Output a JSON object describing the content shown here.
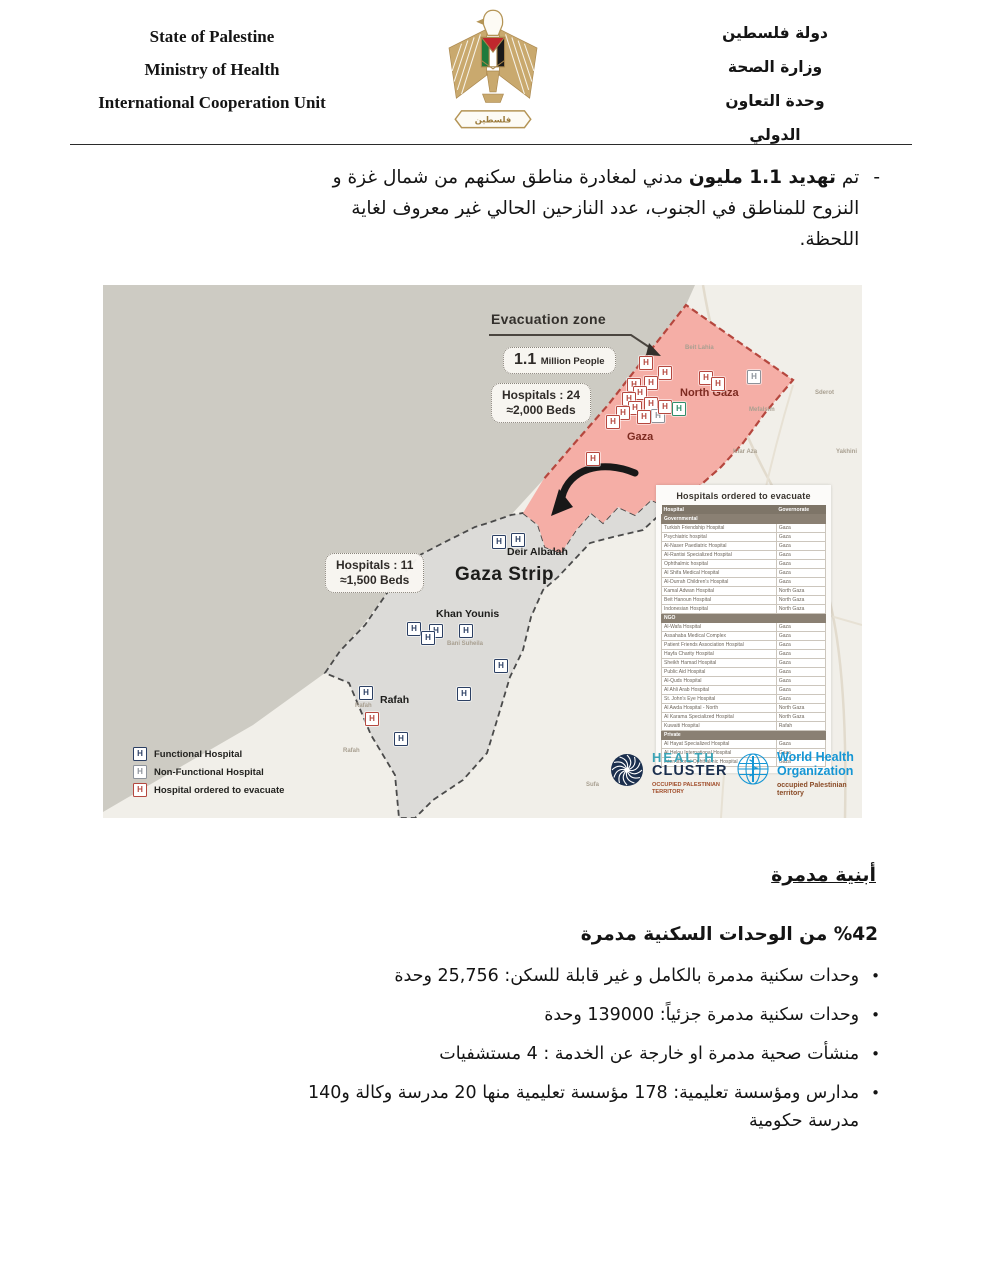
{
  "header": {
    "left_lines": [
      "State of Palestine",
      "Ministry of Health",
      "International Cooperation Unit"
    ],
    "right_lines": [
      "دولة فلسطين",
      "وزارة الصحة",
      "وحدة التعاون الدولي"
    ],
    "emblem_banner": "فلسطين"
  },
  "intro": {
    "dash": "-",
    "pre": "تم ",
    "bold": "تهديد 1.1 مليون",
    "post": " مدني لمغادرة مناطق سكنهم من شمال غزة و النزوح للمناطق في الجنوب، عدد النازحين الحالي غير معروف لغاية اللحظة."
  },
  "map": {
    "marker_letter": "H",
    "evacuation_label": "Evacuation zone",
    "box_people": {
      "big": "1.1",
      "small": "Million People"
    },
    "box_north": {
      "line1": "Hospitals : 24",
      "line2": "≈2,000 Beds"
    },
    "box_south": {
      "line1": "Hospitals : 11",
      "line2": "≈1,500 Beds"
    },
    "region_labels": {
      "north_gaza": "North Gaza",
      "gaza": "Gaza",
      "deir_albalah": "Deir Albalah",
      "gaza_strip": "Gaza Strip",
      "khan_younis": "Khan Younis",
      "rafah": "Rafah"
    },
    "bg_labels": [
      {
        "text": "Beit Lahia",
        "x": 582,
        "y": 60
      },
      {
        "text": "Sderot",
        "x": 712,
        "y": 105
      },
      {
        "text": "Mefalsim",
        "x": 646,
        "y": 122
      },
      {
        "text": "Kfar Aza",
        "x": 630,
        "y": 164
      },
      {
        "text": "Yakhini",
        "x": 733,
        "y": 164
      },
      {
        "text": "Bani Suheila",
        "x": 344,
        "y": 356
      },
      {
        "text": "Rafah",
        "x": 240,
        "y": 463
      },
      {
        "text": "Rafah",
        "x": 252,
        "y": 418
      },
      {
        "text": "Sufa",
        "x": 483,
        "y": 497
      }
    ],
    "markers": [
      {
        "x": 542,
        "y": 77,
        "t": "e"
      },
      {
        "x": 561,
        "y": 87,
        "t": "e"
      },
      {
        "x": 547,
        "y": 97,
        "t": "e"
      },
      {
        "x": 530,
        "y": 99,
        "t": "e"
      },
      {
        "x": 536,
        "y": 107,
        "t": "e"
      },
      {
        "x": 525,
        "y": 113,
        "t": "e"
      },
      {
        "x": 531,
        "y": 122,
        "t": "e"
      },
      {
        "x": 519,
        "y": 127,
        "t": "e"
      },
      {
        "x": 509,
        "y": 136,
        "t": "e"
      },
      {
        "x": 547,
        "y": 118,
        "t": "e"
      },
      {
        "x": 554,
        "y": 130,
        "t": "n"
      },
      {
        "x": 540,
        "y": 131,
        "t": "e"
      },
      {
        "x": 561,
        "y": 121,
        "t": "e"
      },
      {
        "x": 602,
        "y": 92,
        "t": "e"
      },
      {
        "x": 614,
        "y": 98,
        "t": "e"
      },
      {
        "x": 650,
        "y": 91,
        "t": "n"
      },
      {
        "x": 575,
        "y": 123,
        "t": "g"
      },
      {
        "x": 489,
        "y": 173,
        "t": "e"
      },
      {
        "x": 395,
        "y": 256,
        "t": "f"
      },
      {
        "x": 414,
        "y": 254,
        "t": "f"
      },
      {
        "x": 310,
        "y": 343,
        "t": "f"
      },
      {
        "x": 332,
        "y": 345,
        "t": "f"
      },
      {
        "x": 324,
        "y": 352,
        "t": "f"
      },
      {
        "x": 362,
        "y": 345,
        "t": "f"
      },
      {
        "x": 397,
        "y": 380,
        "t": "f"
      },
      {
        "x": 262,
        "y": 407,
        "t": "f"
      },
      {
        "x": 268,
        "y": 433,
        "t": "e"
      },
      {
        "x": 297,
        "y": 453,
        "t": "f"
      },
      {
        "x": 360,
        "y": 408,
        "t": "f"
      }
    ],
    "legend": [
      {
        "type": "f",
        "label": "Functional Hospital"
      },
      {
        "type": "n",
        "label": "Non-Functional Hospital"
      },
      {
        "type": "e",
        "label": "Hospital ordered to evacuate"
      }
    ],
    "table": {
      "title": "Hospitals ordered to evacuate",
      "col1": "Hospital",
      "col2": "Governorate",
      "sections": [
        {
          "name": "Governmental",
          "rows": [
            [
              "Turkish Friendship Hospital",
              "Gaza"
            ],
            [
              "Psychiatric hospital",
              "Gaza"
            ],
            [
              "Al-Naser Paediatric Hospital",
              "Gaza"
            ],
            [
              "Al-Rantisi Specialized Hospital",
              "Gaza"
            ],
            [
              "Ophthalmic hospital",
              "Gaza"
            ],
            [
              "Al Shifa Medical Hospital",
              "Gaza"
            ],
            [
              "Al-Durrah Children's Hospital",
              "Gaza"
            ],
            [
              "Kamal Adwan Hospital",
              "North Gaza"
            ],
            [
              "Beit Hanoun Hospital",
              "North Gaza"
            ],
            [
              "Indonesian Hospital",
              "North Gaza"
            ]
          ]
        },
        {
          "name": "NGO",
          "rows": [
            [
              "Al-Wafa Hospital",
              "Gaza"
            ],
            [
              "Assahaba Medical Complex",
              "Gaza"
            ],
            [
              "Patient Friends Association Hospital",
              "Gaza"
            ],
            [
              "Hayfa Charity Hospital",
              "Gaza"
            ],
            [
              "Sheikh Hamad Hospital",
              "Gaza"
            ],
            [
              "Public Aid Hospital",
              "Gaza"
            ],
            [
              "Al-Quds Hospital",
              "Gaza"
            ],
            [
              "Al Ahli Arab Hospital",
              "Gaza"
            ],
            [
              "St. John's Eye Hospital",
              "Gaza"
            ],
            [
              "Al Awda Hospital - North",
              "North Gaza"
            ],
            [
              "Al Karama Specialized Hospital",
              "North Gaza"
            ],
            [
              "Kuwaiti Hospital",
              "Rafah"
            ]
          ]
        },
        {
          "name": "Private",
          "rows": [
            [
              "Al Hayat Specialized Hospital",
              "Gaza"
            ],
            [
              "Al Helou International Hospital",
              "Gaza"
            ],
            [
              "International Ophthalmic Hospital",
              "Gaza"
            ]
          ]
        }
      ]
    },
    "logos": {
      "health_cluster": {
        "line1": "HEALTH",
        "line2": "CLUSTER",
        "sub": "OCCUPIED PALESTINIAN TERRITORY"
      },
      "who": {
        "line1": "World Health",
        "line2": "Organization",
        "sub1": "occupied Palestinian",
        "sub2": "territory"
      }
    }
  },
  "destroyed": {
    "heading": "أبنية مدمرة",
    "subheading": "%42 من الوحدات السكنية مدمرة",
    "bullet_char": "•",
    "bullets": [
      "وحدات سكنية مدمرة بالكامل و غير قابلة للسكن: 25,756 وحدة",
      "وحدات سكنية مدمرة جزئياً:  139000 وحدة",
      "منشأت صحية مدمرة او خارجة عن الخدمة :  4 مستشفيات",
      "مدارس ومؤسسة تعليمية: 178 مؤسسة تعليمية منها 20  مدرسة وكالة و140 مدرسة حكومية"
    ]
  },
  "colors": {
    "sea": "#cdcbc3",
    "land": "#f1efe9",
    "evacuation_zone": "#f5aea6",
    "evacuation_border": "#b5473e",
    "south_strip": "#dcdbd8",
    "strip_border": "#4a4a4a",
    "maroon_label": "#7d2b21",
    "who_blue": "#1596d4",
    "hc_teal": "#3aa3b5",
    "hc_navy": "#1b2f4e"
  }
}
